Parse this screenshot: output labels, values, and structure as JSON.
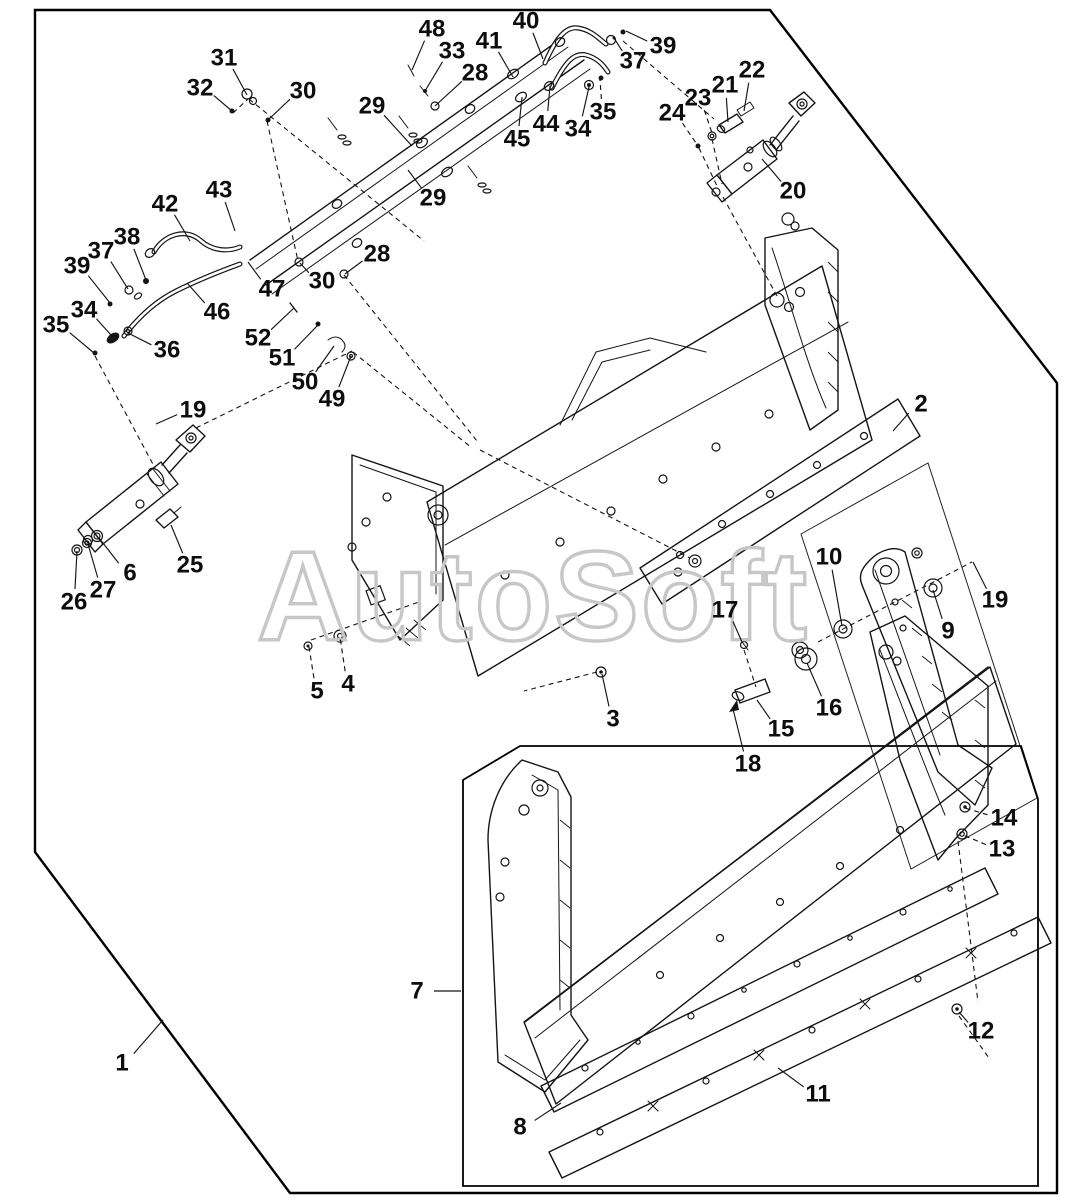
{
  "watermark": "AutoSoft",
  "colors": {
    "line": "#141414",
    "watermark": "#c7c7c7",
    "background": "#ffffff"
  },
  "callouts": [
    {
      "n": "1",
      "x": 122,
      "y": 1063,
      "tx": 163,
      "ty": 1020,
      "dash": false
    },
    {
      "n": "2",
      "x": 921,
      "y": 404,
      "tx": 893,
      "ty": 431,
      "dash": false
    },
    {
      "n": "3",
      "x": 613,
      "y": 719,
      "tx": 602,
      "ty": 674,
      "dash": false
    },
    {
      "n": "4",
      "x": 348,
      "y": 684,
      "tx": 340,
      "ty": 637,
      "dash": true
    },
    {
      "n": "5",
      "x": 317,
      "y": 691,
      "tx": 309,
      "ty": 647,
      "dash": true
    },
    {
      "n": "6",
      "x": 130,
      "y": 573,
      "tx": 99,
      "ty": 538,
      "dash": false
    },
    {
      "n": "7",
      "x": 417,
      "y": 991,
      "tx": 461,
      "ty": 991,
      "dash": false
    },
    {
      "n": "8",
      "x": 520,
      "y": 1127,
      "tx": 561,
      "ty": 1103,
      "dash": false
    },
    {
      "n": "9",
      "x": 948,
      "y": 631,
      "tx": 933,
      "ty": 590,
      "dash": false
    },
    {
      "n": "10",
      "x": 829,
      "y": 557,
      "tx": 842,
      "ty": 626,
      "dash": false
    },
    {
      "n": "11",
      "x": 818,
      "y": 1094,
      "tx": 778,
      "ty": 1068,
      "dash": false
    },
    {
      "n": "12",
      "x": 981,
      "y": 1031,
      "tx": 959,
      "ty": 1012,
      "dash": false
    },
    {
      "n": "13",
      "x": 1002,
      "y": 849,
      "tx": 963,
      "ty": 835,
      "dash": true
    },
    {
      "n": "14",
      "x": 1004,
      "y": 818,
      "tx": 965,
      "ty": 808,
      "dash": true
    },
    {
      "n": "15",
      "x": 781,
      "y": 729,
      "tx": 757,
      "ty": 700,
      "dash": false
    },
    {
      "n": "16",
      "x": 829,
      "y": 708,
      "tx": 807,
      "ty": 663,
      "dash": false
    },
    {
      "n": "17",
      "x": 725,
      "y": 610,
      "tx": 742,
      "ty": 642,
      "dash": false
    },
    {
      "n": "18",
      "x": 748,
      "y": 764,
      "tx": 733,
      "ty": 709,
      "dash": false
    },
    {
      "n": "19",
      "x": 193,
      "y": 410,
      "tx": 156,
      "ty": 424,
      "dash": false
    },
    {
      "n": "19",
      "x": 995,
      "y": 600,
      "tx": 973,
      "ty": 562,
      "dash": false
    },
    {
      "n": "20",
      "x": 793,
      "y": 191,
      "tx": 762,
      "ty": 159,
      "dash": false
    },
    {
      "n": "21",
      "x": 725,
      "y": 85,
      "tx": 728,
      "ty": 122,
      "dash": false
    },
    {
      "n": "22",
      "x": 752,
      "y": 70,
      "tx": 744,
      "ty": 111,
      "dash": false
    },
    {
      "n": "23",
      "x": 698,
      "y": 98,
      "tx": 712,
      "ty": 133,
      "dash": true
    },
    {
      "n": "24",
      "x": 672,
      "y": 113,
      "tx": 698,
      "ty": 146,
      "dash": true
    },
    {
      "n": "25",
      "x": 190,
      "y": 565,
      "tx": 171,
      "ty": 525,
      "dash": false
    },
    {
      "n": "26",
      "x": 74,
      "y": 602,
      "tx": 77,
      "ty": 551,
      "dash": false
    },
    {
      "n": "27",
      "x": 103,
      "y": 590,
      "tx": 88,
      "ty": 544,
      "dash": false
    },
    {
      "n": "28",
      "x": 475,
      "y": 73,
      "tx": 435,
      "ty": 106,
      "dash": false
    },
    {
      "n": "28",
      "x": 377,
      "y": 254,
      "tx": 345,
      "ty": 274,
      "dash": false
    },
    {
      "n": "29",
      "x": 372,
      "y": 106,
      "tx": 412,
      "ty": 146,
      "dash": false
    },
    {
      "n": "29",
      "x": 433,
      "y": 198,
      "tx": 408,
      "ty": 170,
      "dash": false
    },
    {
      "n": "30",
      "x": 303,
      "y": 91,
      "tx": 268,
      "ty": 120,
      "dash": false
    },
    {
      "n": "30",
      "x": 322,
      "y": 281,
      "tx": 300,
      "ty": 263,
      "dash": false
    },
    {
      "n": "31",
      "x": 224,
      "y": 58,
      "tx": 247,
      "ty": 95,
      "dash": false
    },
    {
      "n": "32",
      "x": 200,
      "y": 88,
      "tx": 232,
      "ty": 111,
      "dash": false
    },
    {
      "n": "33",
      "x": 452,
      "y": 51,
      "tx": 425,
      "ty": 91,
      "dash": false
    },
    {
      "n": "34",
      "x": 84,
      "y": 310,
      "tx": 111,
      "ty": 335,
      "dash": false
    },
    {
      "n": "34",
      "x": 578,
      "y": 129,
      "tx": 589,
      "ty": 87,
      "dash": false
    },
    {
      "n": "35",
      "x": 56,
      "y": 325,
      "tx": 94,
      "ty": 353,
      "dash": false
    },
    {
      "n": "35",
      "x": 603,
      "y": 112,
      "tx": 600,
      "ty": 80,
      "dash": true
    },
    {
      "n": "36",
      "x": 167,
      "y": 350,
      "tx": 128,
      "ty": 333,
      "dash": false
    },
    {
      "n": "37",
      "x": 101,
      "y": 251,
      "tx": 128,
      "ty": 289,
      "dash": false
    },
    {
      "n": "37",
      "x": 633,
      "y": 61,
      "tx": 614,
      "ty": 38,
      "dash": false
    },
    {
      "n": "38",
      "x": 127,
      "y": 237,
      "tx": 146,
      "ty": 280,
      "dash": false
    },
    {
      "n": "39",
      "x": 77,
      "y": 266,
      "tx": 110,
      "ty": 303,
      "dash": false
    },
    {
      "n": "39",
      "x": 663,
      "y": 46,
      "tx": 626,
      "ty": 31,
      "dash": false
    },
    {
      "n": "40",
      "x": 526,
      "y": 21,
      "tx": 543,
      "ty": 59,
      "dash": false
    },
    {
      "n": "41",
      "x": 489,
      "y": 41,
      "tx": 513,
      "ty": 77,
      "dash": false
    },
    {
      "n": "42",
      "x": 165,
      "y": 204,
      "tx": 190,
      "ty": 241,
      "dash": false
    },
    {
      "n": "43",
      "x": 219,
      "y": 190,
      "tx": 235,
      "ty": 231,
      "dash": false
    },
    {
      "n": "44",
      "x": 546,
      "y": 124,
      "tx": 550,
      "ty": 86,
      "dash": false
    },
    {
      "n": "45",
      "x": 517,
      "y": 139,
      "tx": 522,
      "ty": 97,
      "dash": false
    },
    {
      "n": "46",
      "x": 217,
      "y": 312,
      "tx": 187,
      "ty": 283,
      "dash": false
    },
    {
      "n": "47",
      "x": 272,
      "y": 289,
      "tx": 248,
      "ty": 262,
      "dash": false
    },
    {
      "n": "48",
      "x": 432,
      "y": 29,
      "tx": 412,
      "ty": 70,
      "dash": false
    },
    {
      "n": "49",
      "x": 332,
      "y": 399,
      "tx": 351,
      "ty": 356,
      "dash": false
    },
    {
      "n": "50",
      "x": 305,
      "y": 382,
      "tx": 334,
      "ty": 346,
      "dash": false
    },
    {
      "n": "51",
      "x": 282,
      "y": 358,
      "tx": 318,
      "ty": 325,
      "dash": false
    },
    {
      "n": "52",
      "x": 258,
      "y": 338,
      "tx": 294,
      "ty": 308,
      "dash": false
    }
  ]
}
